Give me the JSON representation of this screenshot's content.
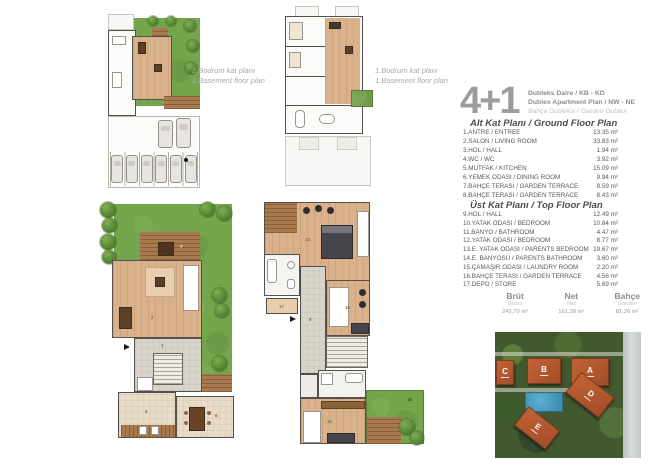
{
  "palette": {
    "garden": "#74a44b",
    "tree": "#4c7a2e",
    "wood": "#d9b28c",
    "deck": "#a87a4e",
    "tilegray": "#d9d4c9",
    "tilebeige": "#e8dcc8",
    "wall": "#55504b",
    "roof": "#a34d28",
    "pool": "#3e8fb4"
  },
  "header": {
    "unit_type": "4+1",
    "title_tr": "Dubleks Daire / KB - KD",
    "title_en": "Dublex Apartment Plan / NW - NE",
    "subtitle": "Bahçe Dubleksi / Garden Dublex"
  },
  "basements": {
    "second": {
      "line1": "2.Bodrum kat planı",
      "line2": "2.Basement floor plan"
    },
    "first": {
      "line1": "1.Bodrum kat planı",
      "line2": "1.Basement floor plan"
    }
  },
  "ground_floor": {
    "title": "Alt Kat Planı / Ground Floor Plan",
    "rooms": [
      {
        "name": "1.ANTRE / ENTREE",
        "area": "13.35 m²"
      },
      {
        "name": "2.SALON / LIVING ROOM",
        "area": "33.83 m²"
      },
      {
        "name": "3.HOL / HALL",
        "area": "1.94 m²"
      },
      {
        "name": "4.WC / WC",
        "area": "3.92 m²"
      },
      {
        "name": "5.MUTFAK / KITCHEN",
        "area": "15.09 m²"
      },
      {
        "name": "6.YEMEK ODASI / DINING ROOM",
        "area": "9.94 m²"
      },
      {
        "name": "7.BAHÇE TERASI / GARDEN TERRACE",
        "area": "8.59 m²"
      },
      {
        "name": "8.BAHÇE TERASI / GARDEN TERRACE",
        "area": "8.43 m²"
      }
    ]
  },
  "top_floor": {
    "title": "Üst Kat Planı / Top Floor Plan",
    "rooms": [
      {
        "name": "9.HOL / HALL",
        "area": "12.49 m²"
      },
      {
        "name": "10.YATAK ODASI / BEDROOM",
        "area": "10.84 m²"
      },
      {
        "name": "11.BANYO / BATHROOM",
        "area": "4.47 m²"
      },
      {
        "name": "12.YATAK ODASI / BEDROOM",
        "area": "8.77 m²"
      },
      {
        "name": "13.E. YATAK ODASI / PARENTS BEDROOM",
        "area": "19.67 m²"
      },
      {
        "name": "14.E. BANYOSU / PARENTS BATHROOM",
        "area": "3.60 m²"
      },
      {
        "name": "15.ÇAMAŞIR ODASI / LAUNDRY ROOM",
        "area": "2.20 m²"
      },
      {
        "name": "16.BAHÇE TERASI / GARDEN TERRACE",
        "area": "4.56 m²"
      },
      {
        "name": "17.DEPO / STORE",
        "area": "5.69 m²"
      }
    ]
  },
  "totals": [
    {
      "label_tr": "Brüt",
      "label_en": "Gross",
      "value": "242,70 m²"
    },
    {
      "label_tr": "Net",
      "label_en": "Net",
      "value": "161,38 m²"
    },
    {
      "label_tr": "Bahçe",
      "label_en": "Garden",
      "value": "81,26 m²"
    }
  ],
  "marks": {
    "g1": "1",
    "g2": "2",
    "g5": "5",
    "g6": "6",
    "g7": "7",
    "g8": "8",
    "t9": "9",
    "t10": "10",
    "t12": "12",
    "t13": "13",
    "t16": "16",
    "t17": "17"
  },
  "site_plan": {
    "buildings": [
      {
        "letter": "C"
      },
      {
        "letter": "B"
      },
      {
        "letter": "A"
      },
      {
        "letter": "D"
      },
      {
        "letter": "E"
      }
    ]
  }
}
